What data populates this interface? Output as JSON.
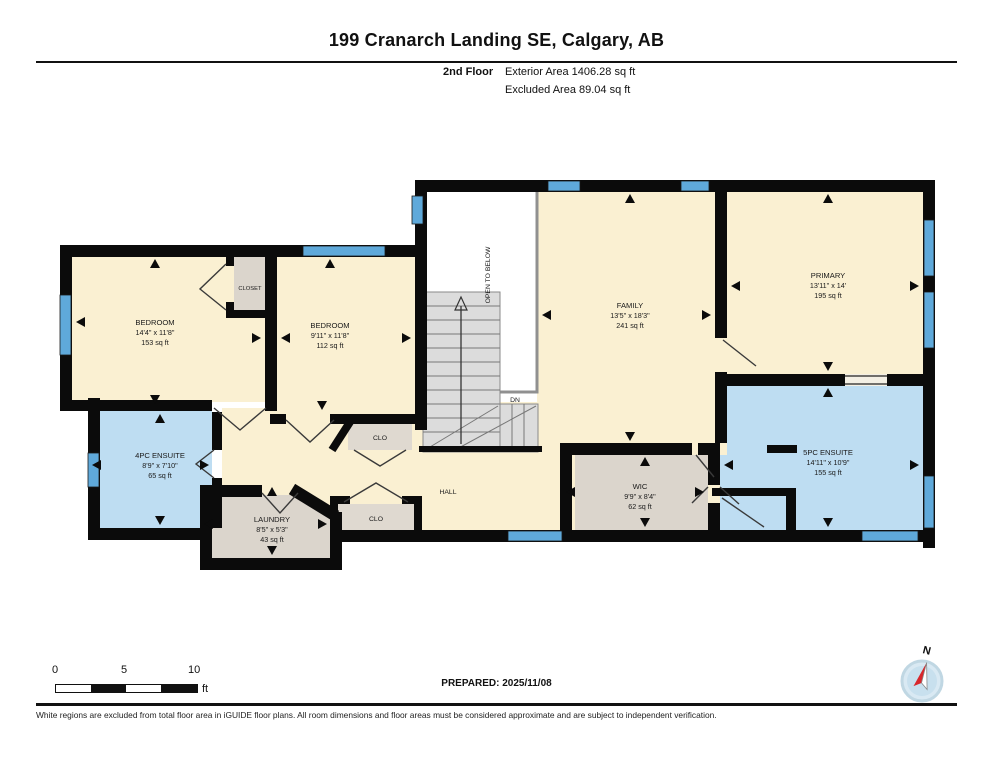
{
  "header": {
    "title": "199 Cranarch Landing SE, Calgary, AB",
    "floor_label": "2nd Floor",
    "exterior_area": "Exterior Area 1406.28 sq ft",
    "excluded_area": "Excluded Area 89.04 sq ft"
  },
  "rooms": {
    "bedroom1": {
      "name": "BEDROOM",
      "dims": "14'4\" x 11'8\"",
      "area": "153 sq ft"
    },
    "bedroom2": {
      "name": "BEDROOM",
      "dims": "9'11\" x 11'8\"",
      "area": "112 sq ft"
    },
    "family": {
      "name": "FAMILY",
      "dims": "13'5\" x 18'3\"",
      "area": "241 sq ft"
    },
    "primary": {
      "name": "PRIMARY",
      "dims": "13'11\" x 14'",
      "area": "195 sq ft"
    },
    "ensuite4": {
      "name": "4PC ENSUITE",
      "dims": "8'9\" x 7'10\"",
      "area": "65 sq ft"
    },
    "ensuite5": {
      "name": "5PC ENSUITE",
      "dims": "14'11\" x 10'9\"",
      "area": "155 sq ft"
    },
    "laundry": {
      "name": "LAUNDRY",
      "dims": "8'5\" x 5'3\"",
      "area": "43 sq ft"
    },
    "wic": {
      "name": "WIC",
      "dims": "9'9\" x 8'4\"",
      "area": "62 sq ft"
    },
    "closet": {
      "name": "CLOSET"
    },
    "clo_upper": {
      "name": "CLO"
    },
    "clo_lower": {
      "name": "CLO"
    },
    "hall": {
      "name": "HALL"
    },
    "open_to_below": {
      "name": "OPEN TO BELOW"
    },
    "stairs_down": {
      "name": "DN"
    }
  },
  "scale_bar": {
    "tick0": "0",
    "tick5": "5",
    "tick10": "10",
    "unit": "ft"
  },
  "prepared": "PREPARED: 2025/11/08",
  "compass": {
    "north_label": "N"
  },
  "footer": {
    "disclaimer": "White regions are excluded from total floor area in iGUIDE floor plans. All room dimensions and floor areas must be considered approximate and are subject to independent verification."
  },
  "colors": {
    "room_fill": "#FAF0D2",
    "wet_room_fill": "#BEDDF2",
    "closet_fill": "#DBD5CC",
    "stair_fill": "#DCDCDC",
    "wall": "#0B0B0B",
    "window": "#5FA9DA",
    "excluded_outline": "#909090"
  }
}
